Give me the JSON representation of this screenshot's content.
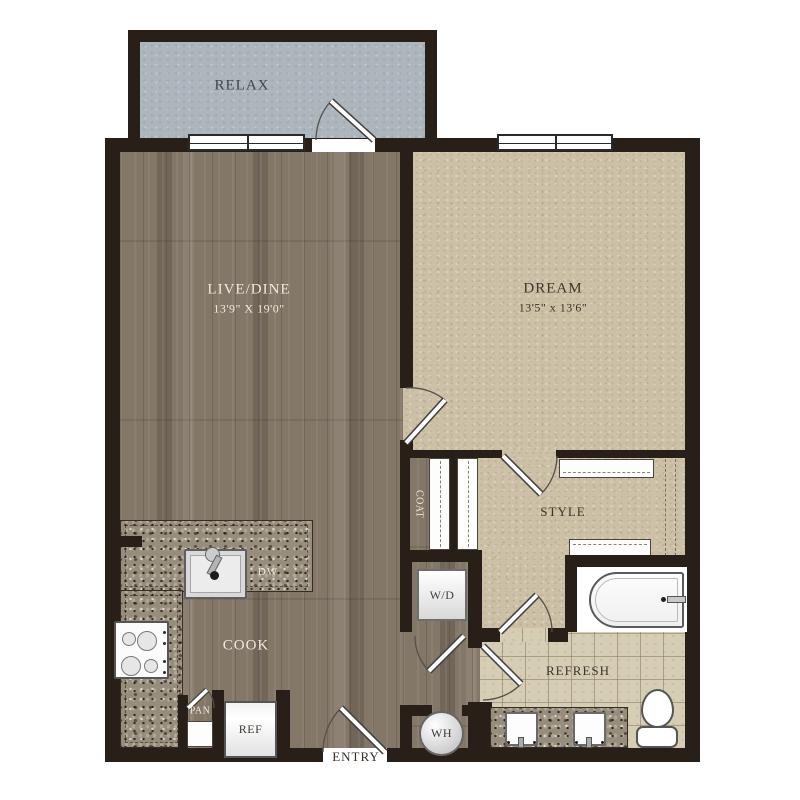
{
  "floorplan": {
    "rooms": {
      "balcony": {
        "label": "RELAX"
      },
      "living": {
        "label": "LIVE/DINE",
        "dims": "13'9\" X 19'0\""
      },
      "bedroom": {
        "label": "DREAM",
        "dims": "13'5\" x 13'6\""
      },
      "coat": {
        "label": "COAT"
      },
      "style": {
        "label": "STYLE"
      },
      "kitchen": {
        "label": "COOK"
      },
      "bath": {
        "label": "REFRESH"
      },
      "entry": {
        "label": "ENTRY"
      }
    },
    "fixtures": {
      "washer_dryer": {
        "label": "W/D"
      },
      "dishwasher": {
        "label": "DW"
      },
      "pantry": {
        "label": "PAN"
      },
      "refrigerator": {
        "label": "REF"
      },
      "water_heater": {
        "label": "WH"
      }
    },
    "palette": {
      "wall": "#271f18",
      "wood_floor": "#837768",
      "carpet": "#ccc1a7",
      "tile": "#d6cdb5",
      "granite": "#978d7c",
      "balcony_floor": "#adb5bd",
      "label_dark": "#3e352a",
      "label_light": "#efeade"
    }
  }
}
